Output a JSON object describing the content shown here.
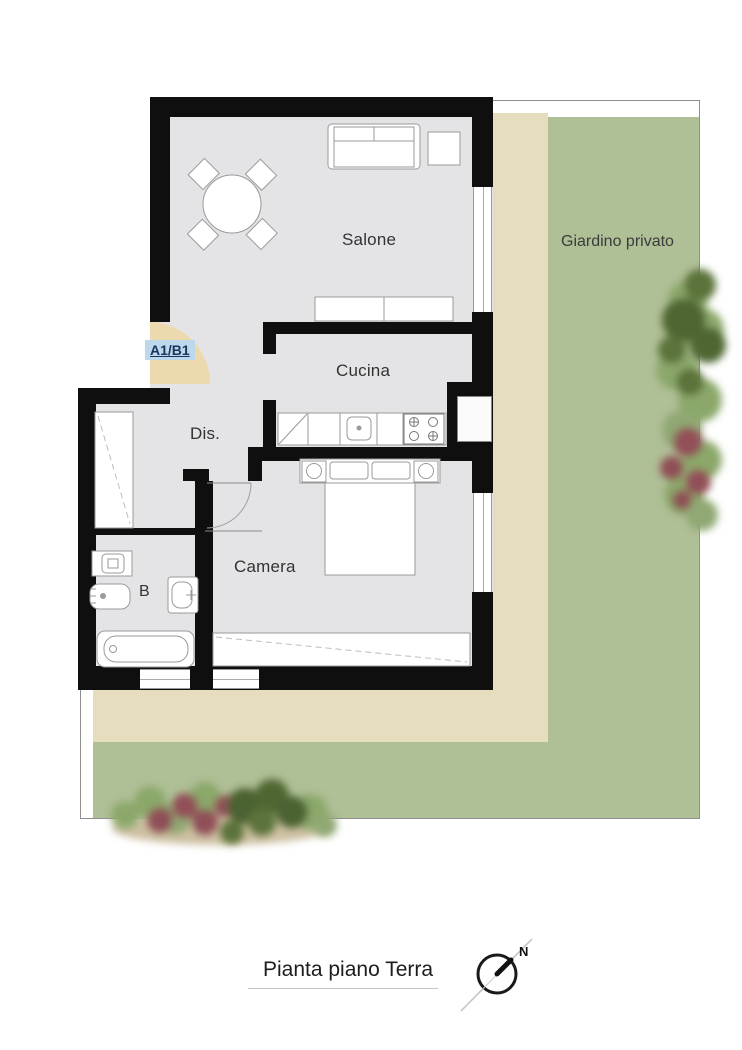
{
  "plan": {
    "caption": "Pianta piano Terra",
    "unit_label": "A1/B1",
    "rooms": {
      "salone": "Salone",
      "cucina": "Cucina",
      "dis": "Dis.",
      "camera": "Camera",
      "bagno": "B"
    },
    "outdoor": {
      "garden_label": "Giardino privato"
    },
    "compass": {
      "north_label": "N"
    }
  },
  "colors": {
    "wall": "#0f0f0f",
    "floor": "#e4e4e6",
    "terrace": "#e6dcbe",
    "garden": "#afbf96",
    "arc": "#ecd9ae",
    "unit_bg": "#bdd7ec",
    "unit_text": "#17365d",
    "dirt": "#cdc0a2"
  }
}
